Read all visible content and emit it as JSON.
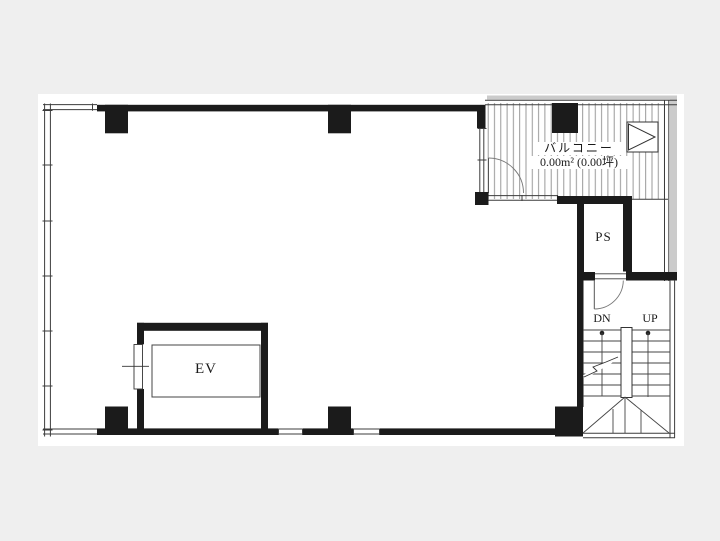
{
  "canvas": {
    "width": 720,
    "height": 541,
    "background": "#efefef",
    "sheet_color": "#ffffff"
  },
  "labels": {
    "balcony": {
      "name": "バルコニー",
      "area": "0.00m² (0.00坪)"
    },
    "pipe_space": "PS",
    "elevator": "EV",
    "stairs_down": "DN",
    "stairs_up": "UP"
  },
  "colors": {
    "wall": "#1b1b1b",
    "thin_line": "#3c3c3c",
    "hatch": "#8f8f8f",
    "outer_shadow": "#cbcbcb",
    "text": "#1a1a1a"
  }
}
